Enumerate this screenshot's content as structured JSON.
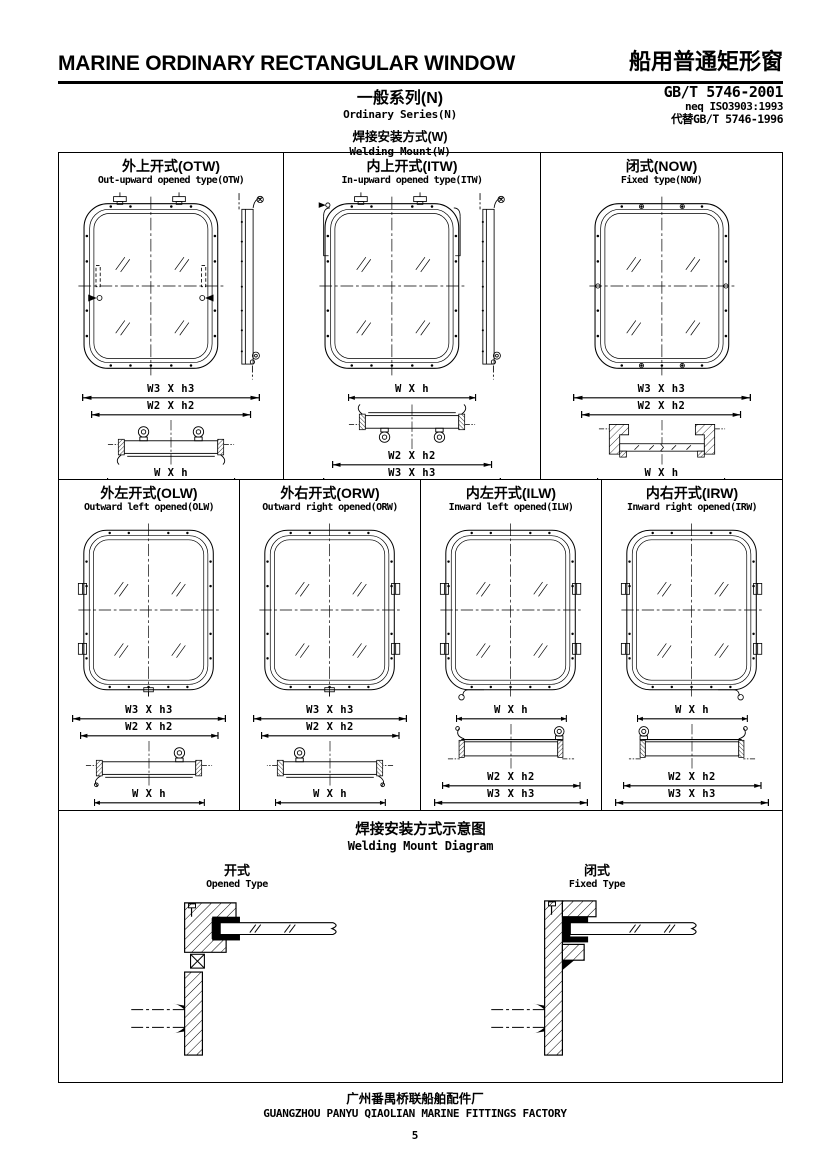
{
  "colors": {
    "ink": "#000000",
    "paper": "#ffffff"
  },
  "header": {
    "title_en": "MARINE ORDINARY RECTANGULAR WINDOW",
    "title_zh": "船用普通矩形窗",
    "standard_code": "GB/T 5746-2001",
    "standard_equiv": "neq ISO3903:1993",
    "standard_replaces": "代替GB/T 5746-1996",
    "series_zh": "一般系列(N)",
    "series_en": "Ordinary Series(N)",
    "mount_zh": "焊接安装方式(W)",
    "mount_en": "Welding Mount(W)"
  },
  "panels": {
    "otw": {
      "title_zh": "外上开式(OTW)",
      "title_en": "Out-upward opened type(OTW)",
      "dims_above": [
        "W3 X h3",
        "W2 X h2"
      ],
      "dims_below": [
        "W X h"
      ]
    },
    "itw": {
      "title_zh": "内上开式(ITW)",
      "title_en": "In-upward opened type(ITW)",
      "dims_above": [
        "W X h"
      ],
      "dims_below": [
        "W2 X h2",
        "W3 X h3"
      ]
    },
    "now": {
      "title_zh": "闭式(NOW)",
      "title_en": "Fixed type(NOW)",
      "dims_above": [
        "W3 X h3",
        "W2 X h2"
      ],
      "dims_below": [
        "W X h"
      ]
    },
    "olw": {
      "title_zh": "外左开式(OLW)",
      "title_en": "Outward left opened(OLW)",
      "dims_above": [
        "W3 X h3",
        "W2 X h2"
      ],
      "dims_below": [
        "W X h"
      ]
    },
    "orw": {
      "title_zh": "外右开式(ORW)",
      "title_en": "Outward right opened(ORW)",
      "dims_above": [
        "W3 X h3",
        "W2 X h2"
      ],
      "dims_below": [
        "W X h"
      ]
    },
    "ilw": {
      "title_zh": "内左开式(ILW)",
      "title_en": "Inward left opened(ILW)",
      "dims_above": [
        "W X h"
      ],
      "dims_below": [
        "W2 X h2",
        "W3 X h3"
      ]
    },
    "irw": {
      "title_zh": "内右开式(IRW)",
      "title_en": "Inward right opened(IRW)",
      "dims_above": [
        "W X h"
      ],
      "dims_below": [
        "W2 X h2",
        "W3 X h3"
      ]
    }
  },
  "welding": {
    "title_zh": "焊接安装方式示意图",
    "title_en": "Welding Mount Diagram",
    "opened_zh": "开式",
    "opened_en": "Opened Type",
    "fixed_zh": "闭式",
    "fixed_en": "Fixed Type"
  },
  "footer": {
    "factory_zh": "广州番禺桥联船舶配件厂",
    "factory_en": "GUANGZHOU PANYU QIAOLIAN MARINE FITTINGS FACTORY",
    "page_number": "5"
  }
}
